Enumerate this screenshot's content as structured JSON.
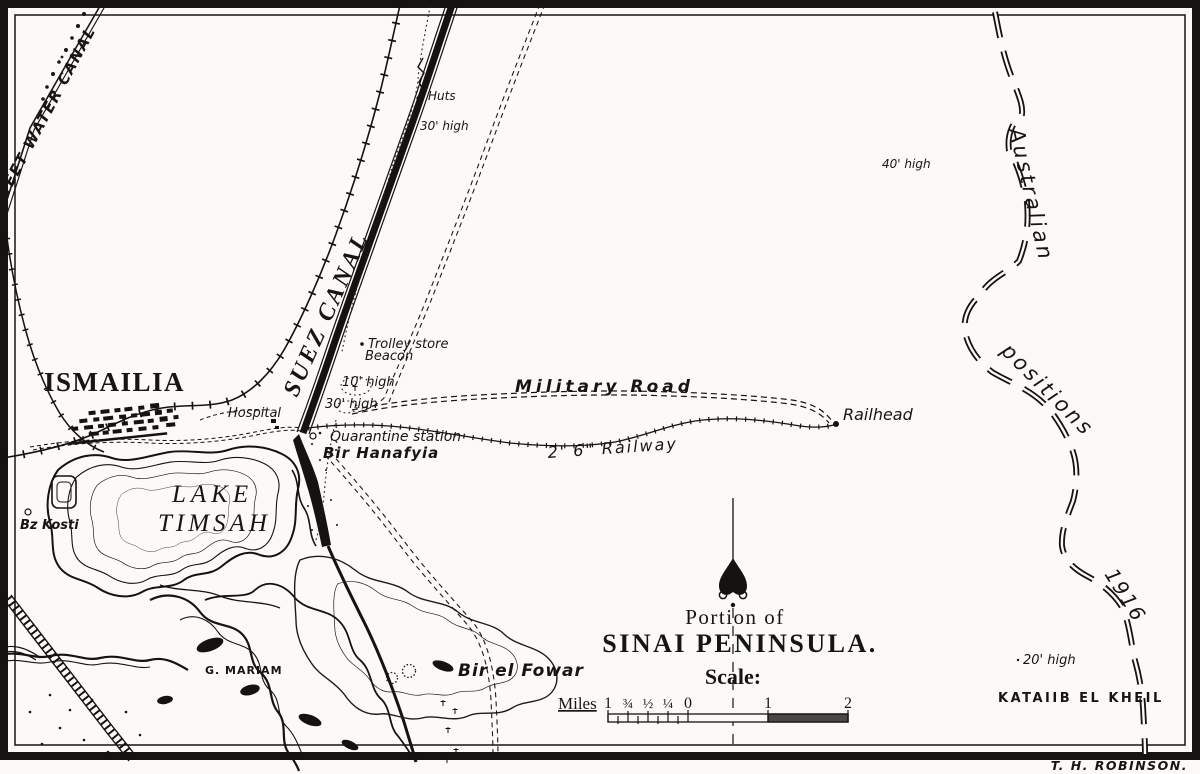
{
  "map": {
    "credit": "T. H. ROBINSON.",
    "title": {
      "line1": "Portion of",
      "line2": "SINAI PENINSULA.",
      "scale_heading": "Scale:"
    },
    "scale_bar": {
      "unit_label": "Miles",
      "ticks": [
        "1",
        "¾",
        "½",
        "¼",
        "0",
        "1",
        "2"
      ]
    },
    "labels": {
      "sweet_water_canal": "SWEET WATER CANAL",
      "suez_canal": "SUEZ CANAL",
      "ismailia": "ISMAILIA",
      "lake_line1": "LAKE",
      "lake_line2": "TIMSAH",
      "huts": "Huts",
      "high_30_north": "30' high",
      "high_10": "10' high",
      "high_30_south": "30' high",
      "high_40": "40' high",
      "high_20": "20' high",
      "trolley_store": "Trolley store",
      "beacon": "Beacon",
      "hospital": "Hospital",
      "quarantine_station": "Quarantine station",
      "bir_hanafyia": "Bir Hanafyia",
      "military_road": "Military Road",
      "light_railway": "2' 6\" Railway",
      "railhead": "Railhead",
      "bz_kosti": "Bz Kosti",
      "g_mariam": "G. MARIAM",
      "bir_el_fowar": "Bir el Fowar",
      "kataiib_el_kheil": "KATAIIB EL KHEIL",
      "australian": "Australian",
      "positions": "positions",
      "year": "1916"
    }
  }
}
